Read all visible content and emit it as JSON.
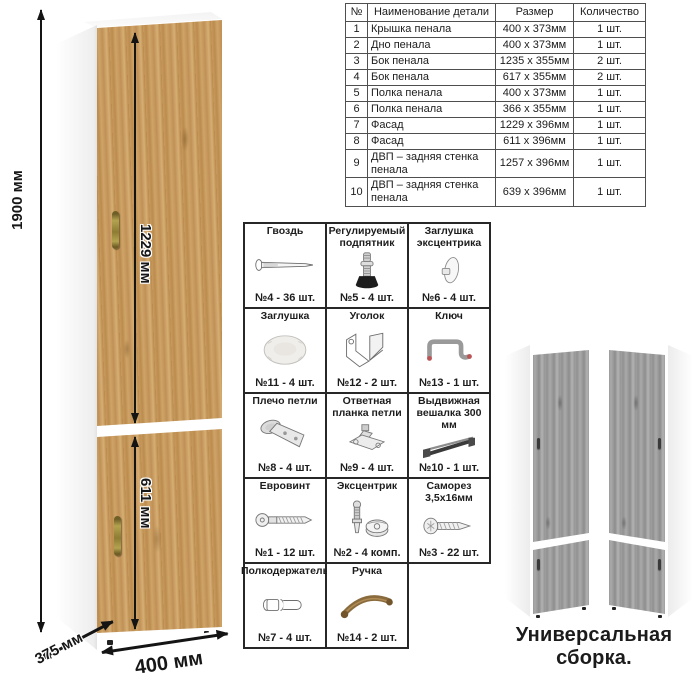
{
  "diagram": {
    "dimensions": {
      "height": "1900 мм",
      "upper_door": "1229 мм",
      "lower_door": "611 мм",
      "depth": "375 мм",
      "width": "400 мм"
    }
  },
  "parts_table": {
    "headers": [
      "№",
      "Наименование детали",
      "Размер",
      "Количество"
    ],
    "rows": [
      [
        "1",
        "Крышка пенала",
        "400 x 373мм",
        "1 шт."
      ],
      [
        "2",
        "Дно пенала",
        "400 x 373мм",
        "1 шт."
      ],
      [
        "3",
        "Бок пенала",
        "1235 x 355мм",
        "2 шт."
      ],
      [
        "4",
        "Бок пенала",
        "617 x 355мм",
        "2 шт."
      ],
      [
        "5",
        "Полка пенала",
        "400 x 373мм",
        "1 шт."
      ],
      [
        "6",
        "Полка пенала",
        "366 x 355мм",
        "1 шт."
      ],
      [
        "7",
        "Фасад",
        "1229 x 396мм",
        "1 шт."
      ],
      [
        "8",
        "Фасад",
        "611 x 396мм",
        "1 шт."
      ],
      [
        "9",
        "ДВП – задняя стенка пенала",
        "1257 x 396мм",
        "1 шт."
      ],
      [
        "10",
        "ДВП – задняя стенка пенала",
        "639 x 396мм",
        "1 шт."
      ]
    ]
  },
  "hardware": {
    "items": [
      {
        "name": "Гвоздь",
        "qty": "№4 - 36 шт.",
        "icon": "nail-icon"
      },
      {
        "name": "Регулируемый подпятник",
        "qty": "№5 - 4 шт.",
        "icon": "adjustable-foot-icon"
      },
      {
        "name": "Заглушка эксцентрика",
        "qty": "№6 - 4 шт.",
        "icon": "cam-cover-icon"
      },
      {
        "name": "Заглушка",
        "qty": "№11 - 4 шт.",
        "icon": "cap-icon"
      },
      {
        "name": "Уголок",
        "qty": "№12 - 2 шт.",
        "icon": "corner-bracket-icon"
      },
      {
        "name": "Ключ",
        "qty": "№13 - 1 шт.",
        "icon": "hex-key-icon"
      },
      {
        "name": "Плечо петли",
        "qty": "№8 - 4 шт.",
        "icon": "hinge-arm-icon"
      },
      {
        "name": "Ответная планка петли",
        "qty": "№9 - 4 шт.",
        "icon": "hinge-plate-icon"
      },
      {
        "name": "Выдвижная вешалка 300 мм",
        "qty": "№10 - 1 шт.",
        "icon": "pullout-hanger-icon"
      },
      {
        "name": "Евровинт",
        "qty": "№1 - 12 шт.",
        "icon": "euro-screw-icon"
      },
      {
        "name": "Эксцентрик",
        "qty": "№2 - 4 комп.",
        "icon": "cam-lock-icon"
      },
      {
        "name": "Саморез 3,5х16мм",
        "qty": "№3 - 22 шт.",
        "icon": "self-tapping-screw-icon"
      },
      {
        "name": "Полкодержатель",
        "qty": "№7 - 4 шт.",
        "icon": "shelf-pin-icon"
      },
      {
        "name": "Ручка",
        "qty": "№14 - 2 шт.",
        "icon": "handle-icon"
      }
    ]
  },
  "footer": {
    "caption": "Универсальная сборка."
  },
  "colors": {
    "wood_light": "#cfa468",
    "wood_dark": "#b9894b",
    "gray_wood": "#9a9a9a",
    "carcass_white": "#ffffff",
    "line_black": "#141414",
    "table_border": "#4f4f4f",
    "handle_bronze": "#8d7c33"
  }
}
